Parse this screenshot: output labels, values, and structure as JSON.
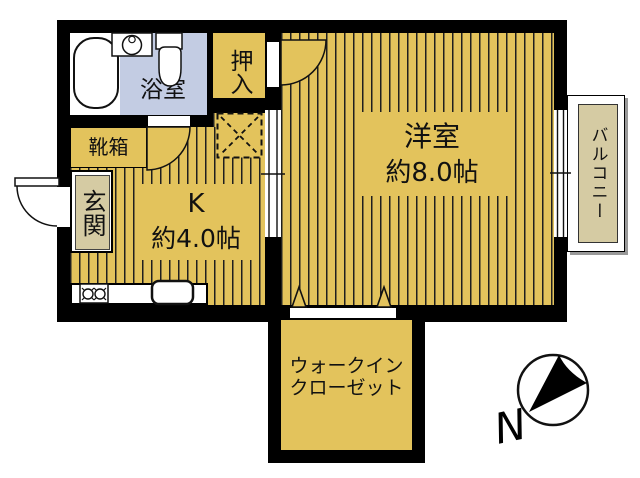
{
  "colors": {
    "floor_gold": "#e3c35c",
    "bathroom_blue": "#c3cce3",
    "khaki_beige": "#d5cba3",
    "wall_black": "#000000",
    "balcony_shadow": "#999999"
  },
  "rooms": {
    "bathroom": {
      "label": "浴室"
    },
    "closet": {
      "label": "押入"
    },
    "western_room": {
      "label": "洋室",
      "size": "約8.0帖"
    },
    "balcony": {
      "label": "バルコニー"
    },
    "shoe_box": {
      "label": "靴箱"
    },
    "entrance": {
      "label": "玄関"
    },
    "kitchen": {
      "label": "K",
      "size": "約4.0帖"
    },
    "walk_in_closet": {
      "line1": "ウォークイン",
      "line2": "クローゼット"
    }
  },
  "compass": {
    "north_label": "N"
  },
  "icons": {
    "bathtub": "bathtub-icon",
    "washing_machine": "washing-machine-icon",
    "toilet": "toilet-icon",
    "stove": "stove-burners-icon",
    "sink": "kitchen-sink-icon",
    "fridge_space": "dashed-x-box",
    "door_arcs": "door-swing-arc",
    "windows": "double-line-window",
    "folding_door": "triangle-markers",
    "compass": "north-arrow-icon"
  }
}
